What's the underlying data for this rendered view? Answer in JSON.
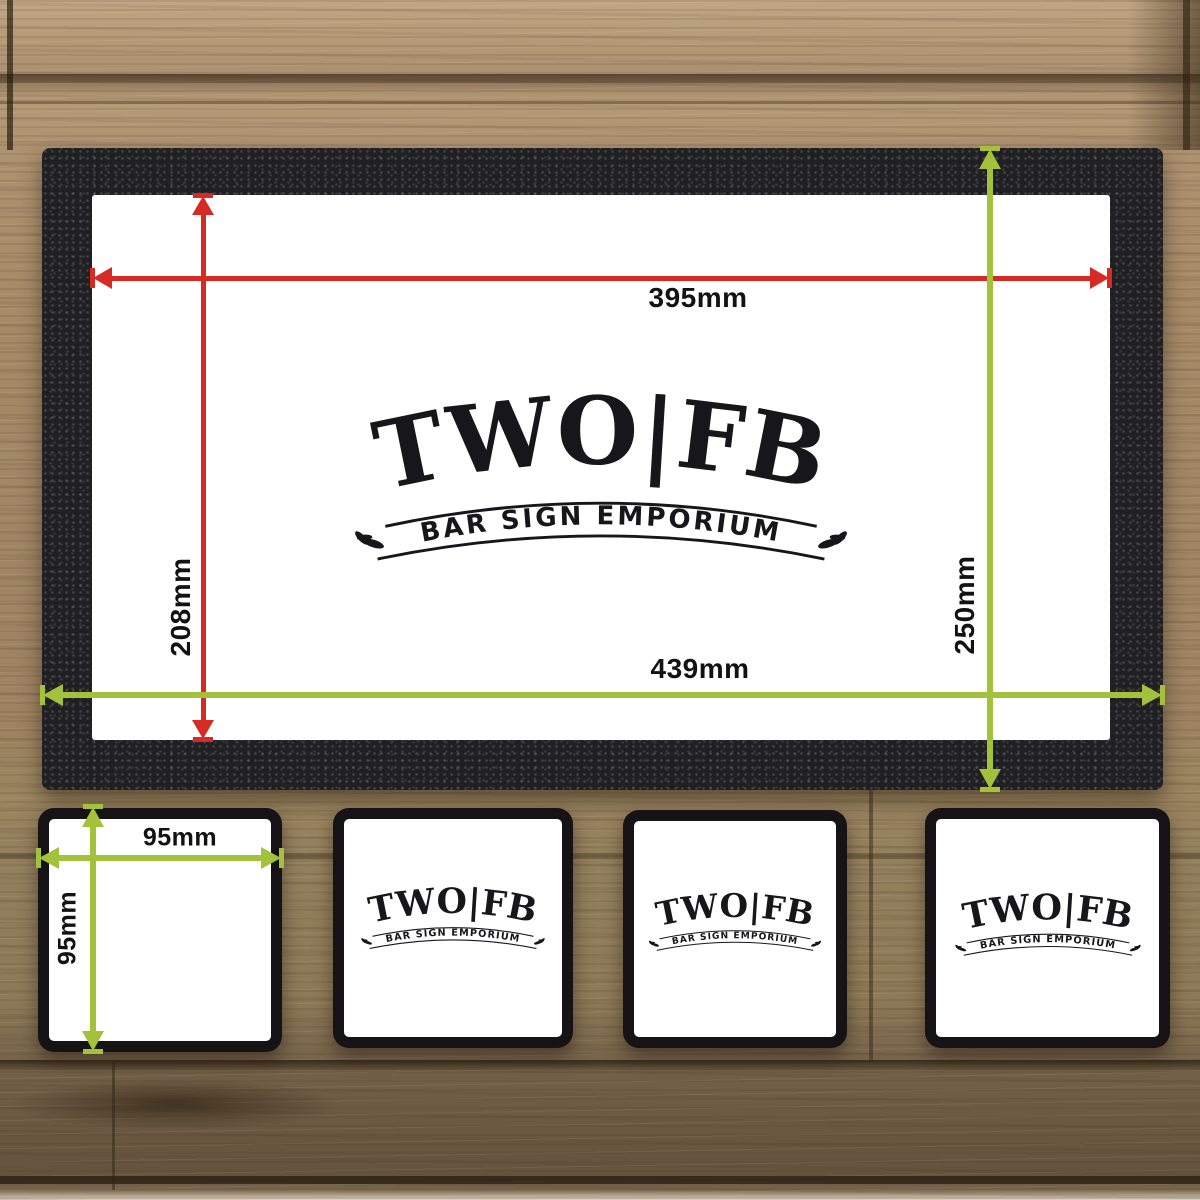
{
  "colors": {
    "dimension_red": "#d62b24",
    "dimension_green": "#a3c13a",
    "mat_black": "#201f22",
    "logo_ink": "#17161a"
  },
  "logo": {
    "wordmark": "TWO|FB",
    "tagline": "BAR SIGN EMPORIUM"
  },
  "bar_runner": {
    "width_inner_label": "395mm",
    "height_inner_label": "208mm",
    "width_outer_label": "439mm",
    "height_outer_label": "250mm"
  },
  "coaster": {
    "width_label": "95mm",
    "height_label": "95mm"
  }
}
